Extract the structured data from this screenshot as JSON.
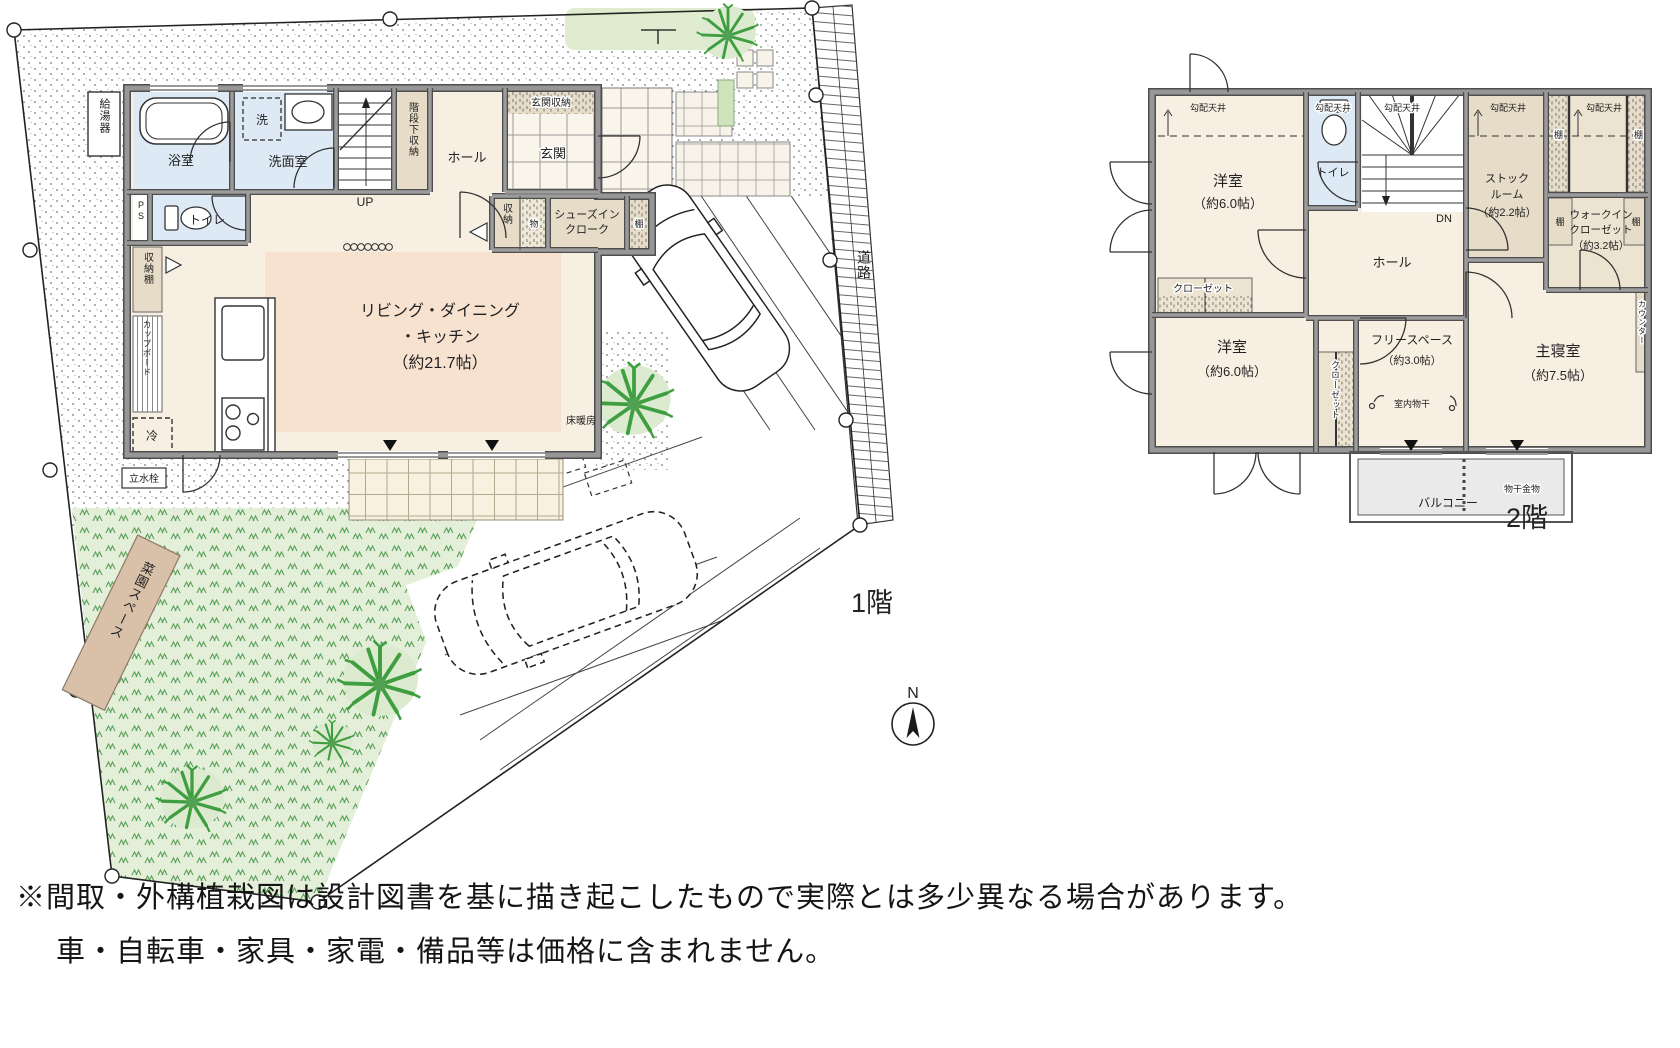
{
  "f1": {
    "label": "1階",
    "compass": "N",
    "water_heater": "給湯器",
    "bath": "浴室",
    "washer": "洗",
    "washroom": "洗面室",
    "understair": "階段下収納",
    "up": "UP",
    "hall": "ホール",
    "entry_storage": "玄関収納",
    "entry": "玄関",
    "toilet": "トイレ",
    "ps": "PS",
    "storage": "収納",
    "goods": "物",
    "sic1": "シューズイン",
    "sic2": "クローク",
    "shelf": "棚",
    "storage_shelf": "収納棚",
    "cupboard": "カップボード",
    "fridge": "冷",
    "ldk1": "リビング・ダイニング",
    "ldk2": "・キッチン",
    "ldk3": "（約21.7帖）",
    "floor_heating": "床暖房",
    "tap": "立水栓",
    "garden": "菜園スペース",
    "road": "道路"
  },
  "f2": {
    "label": "2階",
    "sloped": "勾配天井",
    "western": "洋室",
    "six": "（約6.0帖）",
    "closet": "クローゼット",
    "toilet": "トイレ",
    "dn": "DN",
    "hall": "ホール",
    "stock1": "ストック",
    "stock2": "ルーム",
    "stock3": "（約2.2帖）",
    "shelf": "棚",
    "wic1": "ウォークイン",
    "wic2": "クローゼット",
    "wic3": "（約3.2帖）",
    "free1": "フリースペース",
    "free2": "（約3.0帖）",
    "drying": "室内物干",
    "master": "主寝室",
    "master_size": "（約7.5帖）",
    "counter": "カウンター",
    "balcony": "バルコニー",
    "hanger": "物干金物"
  },
  "notes": {
    "line1": "※間取・外構植栽図は設計図書を基に描き起こしたもので実際とは多少異なる場合があります。",
    "line2": "車・自転車・家具・家電・備品等は価格に含まれません。"
  },
  "colors": {
    "wall": "#8f8f8f",
    "wet_room": "#dde9f4",
    "floor_cream": "#f8efe3",
    "ldk_highlight": "#f7e2d0",
    "storage_tan": "#e6dcc8",
    "lawn": "#e3efd8",
    "grass_mark": "#5a9f5a",
    "tree": "#3f9e3f",
    "garden_plot": "#d9c0a9",
    "balcony": "#eaeaea"
  }
}
